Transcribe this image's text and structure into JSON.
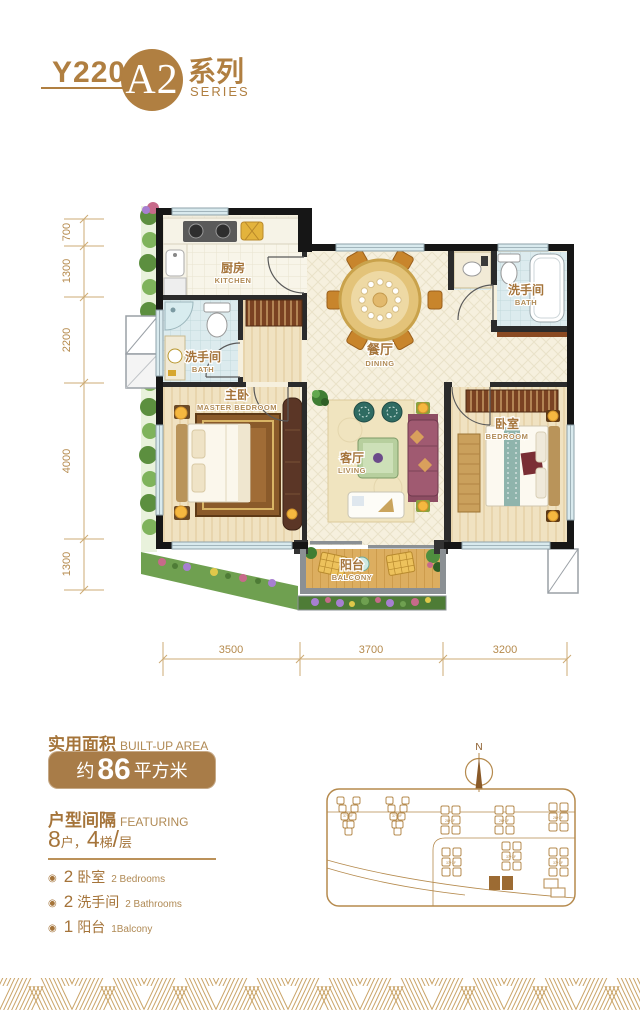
{
  "header": {
    "model": "Y220",
    "unit": "A2",
    "series_zh": "系列",
    "series_en": "SERIES"
  },
  "floorplan": {
    "rooms": {
      "kitchen": {
        "zh": "厨房",
        "en": "KITCHEN"
      },
      "bath_left": {
        "zh": "洗手间",
        "en": "BATH"
      },
      "bath_right": {
        "zh": "洗手间",
        "en": "BATH"
      },
      "dining": {
        "zh": "餐厅",
        "en": "DINING"
      },
      "master": {
        "zh": "主卧",
        "en": "MASTER BEDROOM"
      },
      "living": {
        "zh": "客厅",
        "en": "LIVING"
      },
      "bedroom": {
        "zh": "卧室",
        "en": "BEDROOM"
      },
      "balcony": {
        "zh": "阳台",
        "en": "BALCONY"
      }
    },
    "dims_left": [
      "700",
      "1300",
      "2200",
      "4000",
      "1300"
    ],
    "dims_bottom": [
      "3500",
      "3700",
      "3200"
    ]
  },
  "info": {
    "area_label_zh": "实用面积",
    "area_label_en": "BUILT-UP AREA",
    "area_prefix": "约",
    "area_value": "86",
    "area_unit": "平方米",
    "featuring_zh": "户型间隔",
    "featuring_en": "FEATURING",
    "layout": {
      "n1": "8",
      "u1": "户",
      "sep": "，",
      "n2": "4",
      "u2": "梯",
      "slash": "/",
      "u3": "层"
    },
    "features": [
      {
        "num": "2",
        "zh": "卧室",
        "en": "2 Bedrooms"
      },
      {
        "num": "2",
        "zh": "洗手间",
        "en": "2 Bathrooms"
      },
      {
        "num": "1",
        "zh": "阳台",
        "en": "1Balcony"
      }
    ]
  },
  "siteplan": {
    "north": "N",
    "buildings": [
      "37+3F",
      "37+3F",
      "26+3F",
      "26+3F",
      "26+3F",
      "37+3F",
      "37+3F",
      "37+3F"
    ]
  }
}
